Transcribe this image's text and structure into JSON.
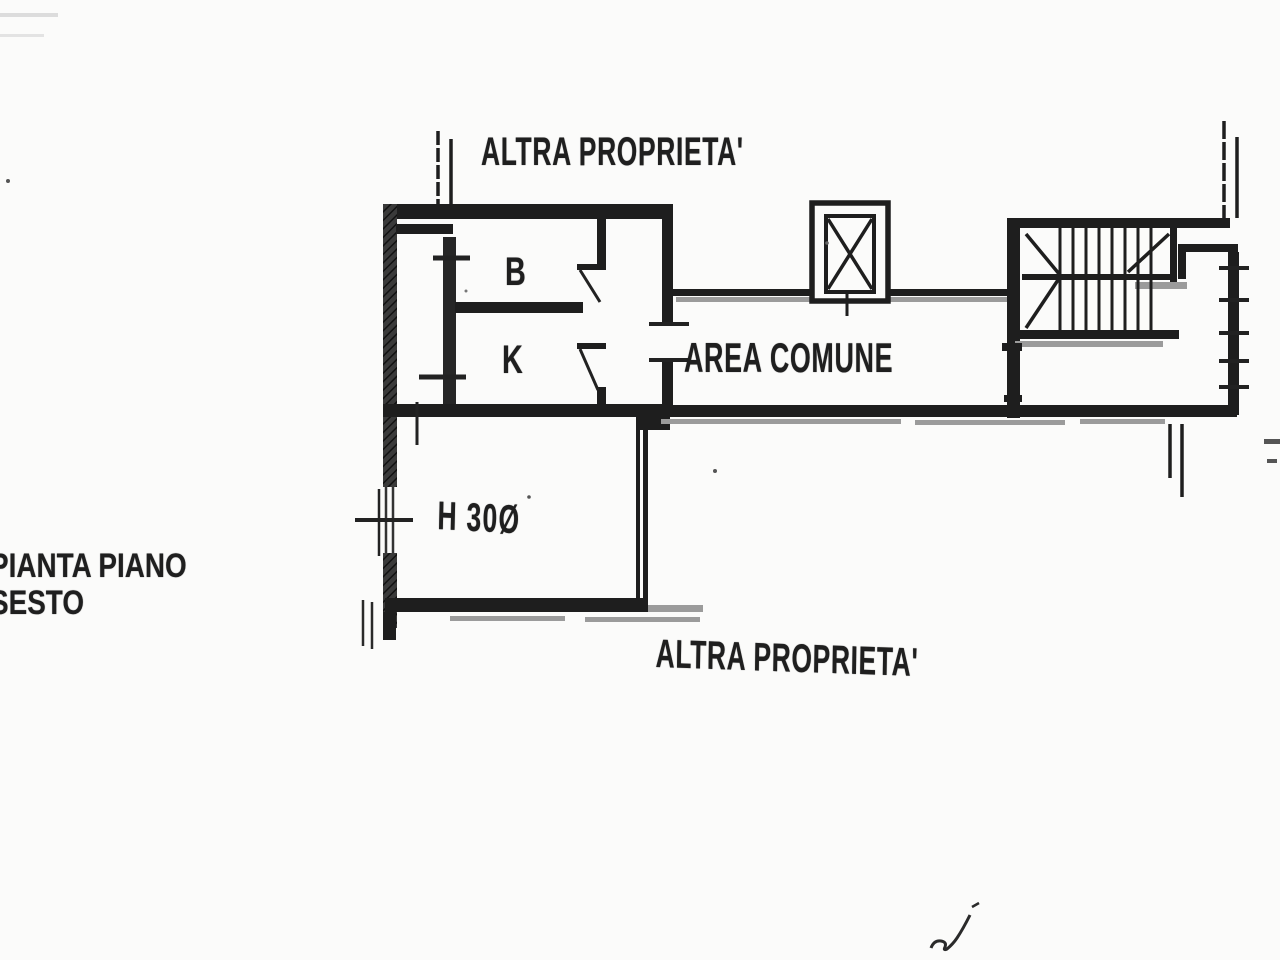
{
  "labels": {
    "other_property_top": "ALTRA PROPRIETA'",
    "common_area": "AREA COMUNE",
    "room_b": "B",
    "room_k": "K",
    "room_height": "H 30Ø",
    "plan_title_line1": "PIANTA PIANO",
    "plan_title_line2": "SESTO",
    "other_property_bottom": "ALTRA PROPRIETA'"
  },
  "drawing": {
    "type": "floor-plan",
    "floor": "sesto (sixth)",
    "rooms_labeled": [
      "B",
      "K",
      "AREA COMUNE",
      "H 30Ø"
    ],
    "features": [
      "elevator-shaft",
      "staircase",
      "balcony-strip",
      "door-swings",
      "window-ticks",
      "signature-squiggle"
    ],
    "colors": {
      "ink": "#1e1e1e",
      "secondary_gray": "#9b9b9b",
      "background": "#fbfbfa"
    }
  }
}
